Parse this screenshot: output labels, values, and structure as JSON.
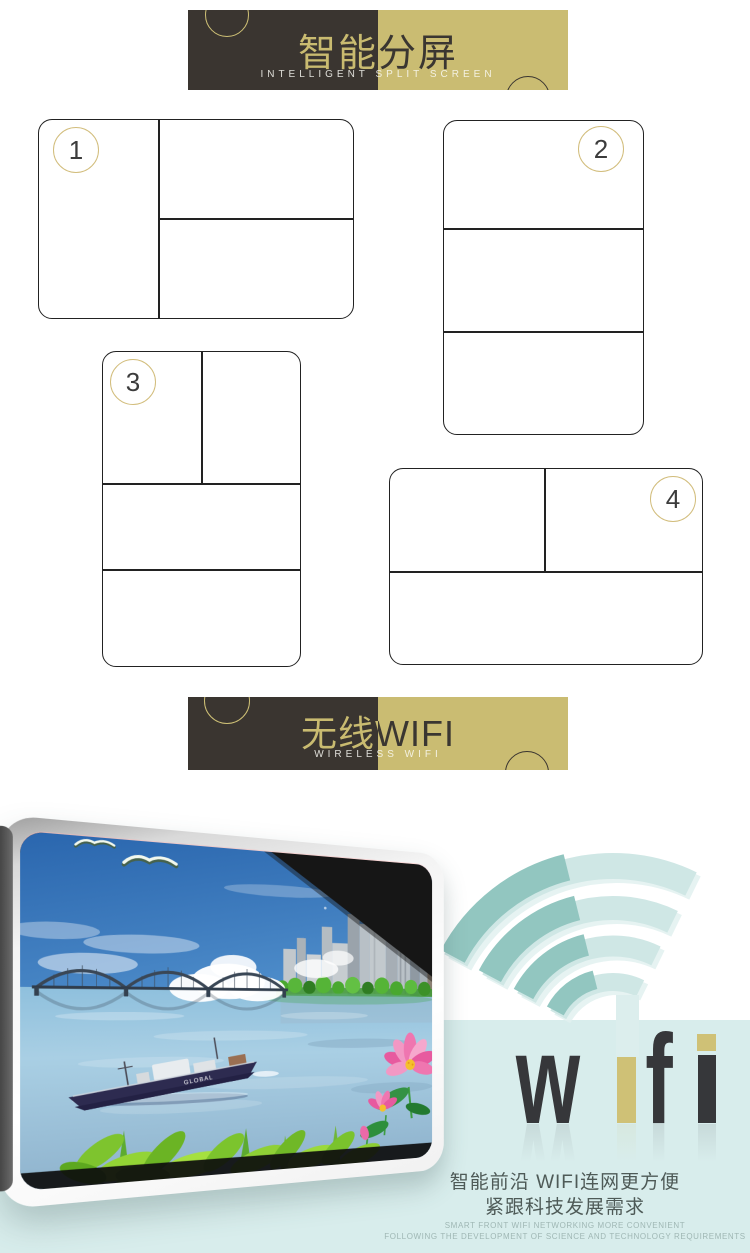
{
  "banners": {
    "split_screen": {
      "title": "智能分屏",
      "subtitle": "INTELLIGENT SPLIT SCREEN"
    },
    "wireless": {
      "title": "无线WIFI",
      "subtitle": "WIRELESS WIFI"
    }
  },
  "split_layouts": [
    {
      "number": "1"
    },
    {
      "number": "2"
    },
    {
      "number": "3"
    },
    {
      "number": "4"
    }
  ],
  "wifi_wordmark": {
    "letter_w": "w",
    "letter_f": "f"
  },
  "monitor_screen": {
    "ship_label": "GLOBAL"
  },
  "footer": {
    "cn_line1": "智能前沿 WIFI连网更方便",
    "cn_line2": "紧跟科技发展需求",
    "en_line1": "SMART FRONT WIFI NETWORKING MORE CONVENIENT",
    "en_line2": "FOLLOWING THE DEVELOPMENT OF SCIENCE AND TECHNOLOGY REQUIREMENTS"
  },
  "colors": {
    "banner_dark": "#3a3530",
    "banner_gold": "#cabc72",
    "teal_band": "#d8edec",
    "arc_dark": "#92c6c0",
    "arc_light": "#cfe7e5",
    "wifi_text_dark": "#36373a",
    "wifi_text_gold": "#cfc176"
  }
}
